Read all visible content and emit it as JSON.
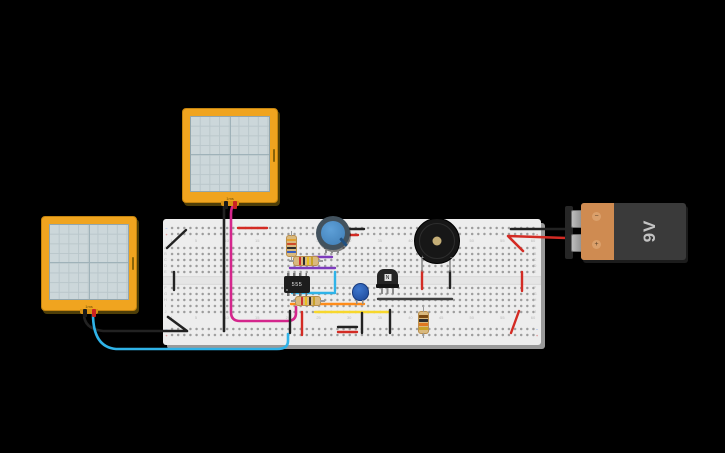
{
  "scene": {
    "background": "#000000"
  },
  "scopes": {
    "top": {
      "time_label": "1ms"
    },
    "bottom": {
      "time_label": "1ms"
    }
  },
  "battery": {
    "label": "9V",
    "minus_symbol": "−",
    "plus_symbol": "+"
  },
  "buzzer": {
    "plus_symbol": "+",
    "minus_symbol": "−"
  },
  "ic": {
    "label": "555"
  },
  "transistor": {
    "label": "N"
  },
  "breadboard": {
    "rail_minus": "−",
    "rail_plus": "+",
    "column_numbers": [
      "1",
      "5",
      "10",
      "15",
      "20",
      "25",
      "30",
      "35",
      "40",
      "45",
      "50",
      "55",
      "60"
    ],
    "row_letters_top": [
      "A",
      "B",
      "C",
      "D",
      "E"
    ],
    "row_letters_bottom": [
      "F",
      "G",
      "H",
      "I",
      "J"
    ]
  },
  "colors": {
    "red": "#d32b24",
    "black": "#222222",
    "magenta": "#d4268c",
    "cyan": "#2fb3e8",
    "purple": "#7d3bbd",
    "orange": "#ff8c1a",
    "yellow": "#f7d72c",
    "gray": "#8c8c8c",
    "board": "#ededed",
    "scope_frame": "#f0a41f",
    "battery_body": "#3a3a3a",
    "battery_accent": "#cf8b51",
    "knob_blue": "#4f8fc9",
    "cap_blue": "#2458b3"
  },
  "resistors": [
    {
      "bands": [
        "#e0a030",
        "#cf4a28",
        "#2c2c2c",
        "#3a5fc0"
      ]
    },
    {
      "bands": [
        "#cf3030",
        "#2c2c2c",
        "#e8c020",
        "#c9a227"
      ]
    },
    {
      "bands": [
        "#cf3030",
        "#e8c020",
        "#2c2c2c",
        "#c9a227"
      ]
    },
    {
      "bands": [
        "#7b4a12",
        "#2c2c2c",
        "#e07820",
        "#c9a227"
      ]
    }
  ],
  "wires": [
    {
      "name": "scope-top-probe-black",
      "color": "#222222",
      "w": 2.6,
      "d": "M224,205 L224,331"
    },
    {
      "name": "scope-top-probe-magenta",
      "color": "#d4268c",
      "w": 2.6,
      "d": "M234,205 Q231,207 231,214 L231,312 Q231,321 240,321 L287,321 Q296,321 296,313 L296,307"
    },
    {
      "name": "scope-bottom-probe-black",
      "color": "#222222",
      "w": 2.6,
      "d": "M84,314 Q84,329 103,331 L187,331 L168,317"
    },
    {
      "name": "scope-bottom-probe-cyan",
      "color": "#2fb3e8",
      "w": 2.6,
      "d": "M93,314 Q93,347 116,349 L277,349 Q288,349 288,341 L288,334"
    },
    {
      "name": "rail-jumper-red-left",
      "color": "#d32b24",
      "w": 2.4,
      "d": "M238,228 L267,228"
    },
    {
      "name": "pot-wire-black",
      "color": "#222222",
      "w": 2.4,
      "d": "M342,229 L364,229"
    },
    {
      "name": "pot-wire-red",
      "color": "#d32b24",
      "w": 2.4,
      "d": "M339,235 L358,235"
    },
    {
      "name": "battery-wire-black",
      "color": "#222222",
      "w": 2.6,
      "d": "M511,229 L566,229"
    },
    {
      "name": "battery-wire-red",
      "color": "#d32b24",
      "w": 2.6,
      "d": "M566,238 L508,236 L523,251"
    },
    {
      "name": "jumper-red-right",
      "color": "#d32b24",
      "w": 2.4,
      "d": "M522,272 L522,291"
    },
    {
      "name": "jumper-red-bottom-right",
      "color": "#d32b24",
      "w": 2.4,
      "d": "M519,311 L511,333"
    },
    {
      "name": "buzzer-jumper-red",
      "color": "#d32b24",
      "w": 2.4,
      "d": "M422,271 L422,289"
    },
    {
      "name": "buzzer-jumper-black",
      "color": "#222222",
      "w": 2.4,
      "d": "M450,271 L450,288"
    },
    {
      "name": "jumper-gray-row-h",
      "color": "#3f3f3f",
      "w": 2.4,
      "d": "M378,299 L452,299"
    },
    {
      "name": "jumper-purple-1",
      "color": "#7d3bbd",
      "w": 2.4,
      "d": "M313,257 L332,257"
    },
    {
      "name": "jumper-purple-2",
      "color": "#7d3bbd",
      "w": 2.4,
      "d": "M290,268 L335,268"
    },
    {
      "name": "jumper-cyan-vertical",
      "color": "#2fb3e8",
      "w": 2.4,
      "d": "M335,272 L335,291"
    },
    {
      "name": "jumper-cyan-horizontal",
      "color": "#2fb3e8",
      "w": 2.4,
      "d": "M292,293 L335,293"
    },
    {
      "name": "jumper-orange",
      "color": "#ff8c1a",
      "w": 2.4,
      "d": "M291,304 L364,304"
    },
    {
      "name": "jumper-yellow",
      "color": "#f7d72c",
      "w": 2.4,
      "d": "M315,312 L390,312"
    },
    {
      "name": "jumper-black-mid",
      "color": "#222222",
      "w": 2.4,
      "d": "M290,311 L290,333"
    },
    {
      "name": "jumper-red-mid",
      "color": "#d32b24",
      "w": 2.4,
      "d": "M302,312 L302,335"
    },
    {
      "name": "jumper-black-2",
      "color": "#222222",
      "w": 2.4,
      "d": "M362,313 L362,333"
    },
    {
      "name": "jumper-black-3",
      "color": "#222222",
      "w": 2.4,
      "d": "M390,310 L390,333"
    },
    {
      "name": "rail-jumper-black-bottom",
      "color": "#222222",
      "w": 2.4,
      "d": "M338,327 L357,327"
    },
    {
      "name": "rail-jumper-red-bottom",
      "color": "#d32b24",
      "w": 2.4,
      "d": "M338,332 L357,332"
    },
    {
      "name": "jumper-black-diag-top-left",
      "color": "#222222",
      "w": 2.4,
      "d": "M167,248 L186,230"
    },
    {
      "name": "jumper-black-left-vertical",
      "color": "#222222",
      "w": 2.4,
      "d": "M174,272 L174,290"
    },
    {
      "name": "buzzer-pin-left",
      "color": "#8c8c8c",
      "w": 1.6,
      "d": "M422,256 L422,271"
    },
    {
      "name": "buzzer-pin-right",
      "color": "#8c8c8c",
      "w": 1.6,
      "d": "M450,256 L450,271"
    }
  ]
}
